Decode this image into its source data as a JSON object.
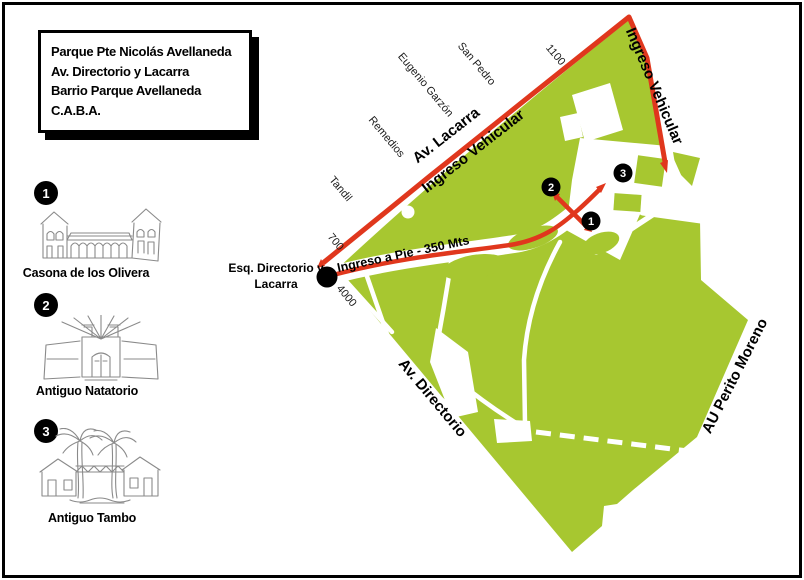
{
  "title_box": {
    "line1": "Parque Pte Nicolás Avellaneda",
    "line2": "Av. Directorio y Lacarra",
    "line3": "Barrio Parque Avellaneda",
    "line4": "C.A.B.A."
  },
  "legend": {
    "items": [
      {
        "number": "1",
        "label": "Casona de los Olivera",
        "icon": "casona-building-sketch"
      },
      {
        "number": "2",
        "label": "Antiguo Natatorio",
        "icon": "natatorio-building-sketch"
      },
      {
        "number": "3",
        "label": "Antiguo Tambo",
        "icon": "tambo-palms-sketch"
      }
    ]
  },
  "map": {
    "colors": {
      "park_green": "#a7c730",
      "route_red": "#e0371d",
      "sketch_gray": "#8a8a8a"
    },
    "streets": {
      "tandil": "Tandil",
      "remedios": "Remedios",
      "eugenio_garzon": "Eugenio Garzón",
      "san_pedro": "San Pedro",
      "av_lacarra": "Av. Lacarra",
      "av_directorio": "Av. Directorio",
      "au_perito_moreno": "AU Perito Moreno"
    },
    "street_numbers": {
      "n700": "700",
      "n1100": "1100",
      "n4000": "4000"
    },
    "entrances": {
      "vehicular_lacarra": "Ingreso  Vehicular",
      "vehicular_right": "Ingreso  Vehicular",
      "pedestrian": "Ingreso a Pie - 350 Mts"
    },
    "corner_label": {
      "line1": "Esq. Directorio y",
      "line2": "Lacarra"
    },
    "markers": [
      {
        "number": "1"
      },
      {
        "number": "2"
      },
      {
        "number": "3"
      }
    ]
  }
}
